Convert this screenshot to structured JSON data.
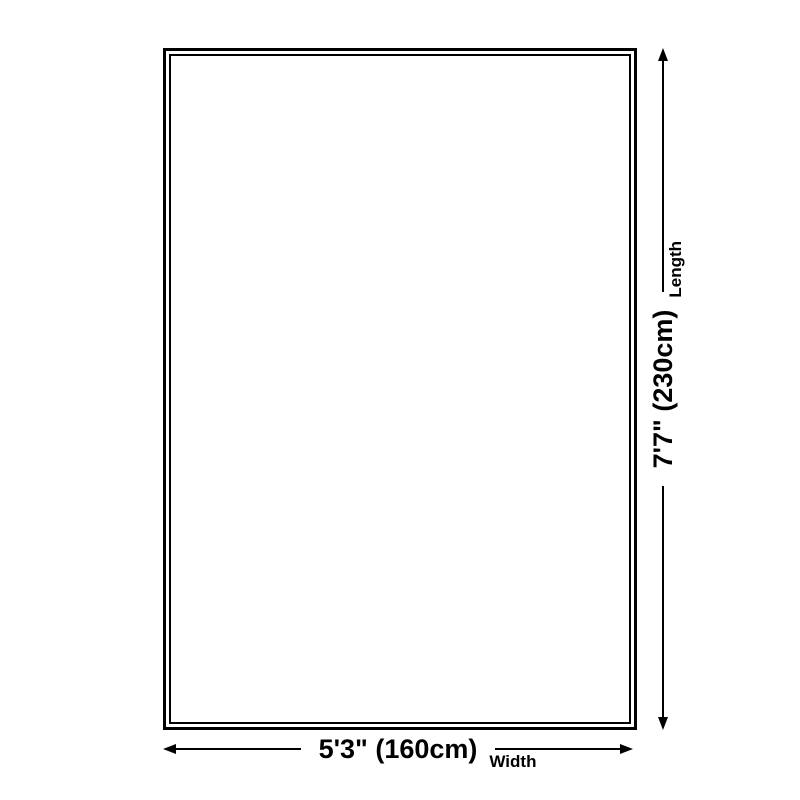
{
  "page": {
    "background_color": "#ffffff",
    "line_color": "#000000"
  },
  "rug": {
    "shape": "rectangle",
    "outline": "double-line"
  },
  "dimensions": {
    "width": {
      "value_label": "5'3\" (160cm)",
      "axis_label": "Width"
    },
    "length": {
      "value_label": "7'7\" (230cm)",
      "axis_label": "Length"
    }
  },
  "icons": {
    "width_arrows": [
      "arrow-left-icon",
      "arrow-right-icon"
    ],
    "length_arrows": [
      "arrow-down-icon",
      "arrow-up-icon"
    ]
  }
}
